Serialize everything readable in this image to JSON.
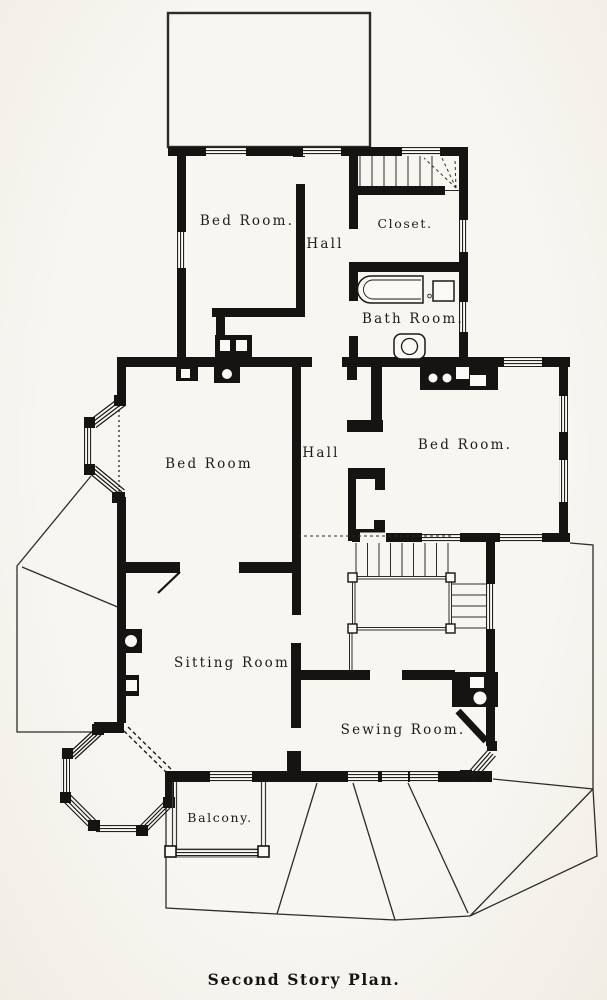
{
  "labels": {
    "bed_room_upper": "Bed Room.",
    "hall_upper": "Hall",
    "closet": "Closet.",
    "bath_room": "Bath Room.",
    "bed_room_middle": "Bed Room",
    "hall_middle": "Hall",
    "bed_room_right": "Bed Room.",
    "sitting_room": "Sitting Room",
    "sewing_room": "Sewing Room.",
    "balcony": "Balcony.",
    "caption": "Second Story Plan."
  },
  "colors": {
    "ink": "#1c1a17",
    "paper": "#f6f4ee",
    "thin_line": "#2e2c29"
  }
}
